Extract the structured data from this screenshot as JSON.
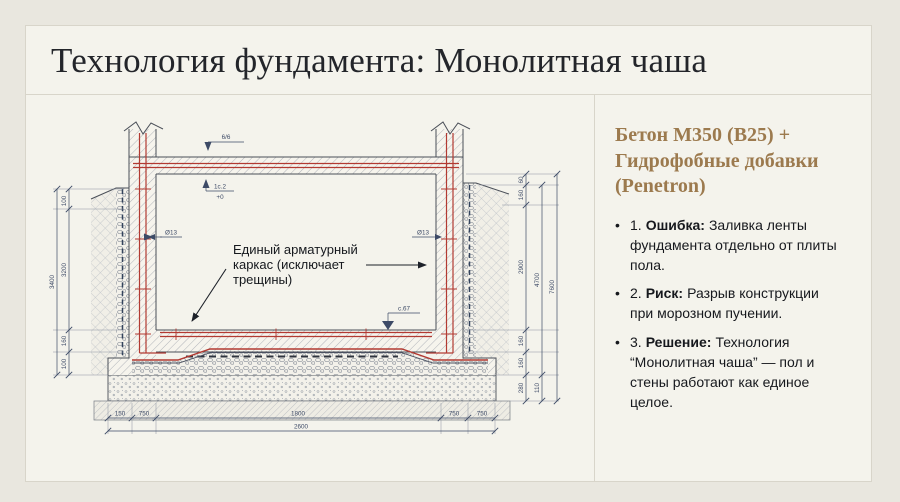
{
  "title": "Технология фундамента: Монолитная чаша",
  "colors": {
    "accent_heading": "#9c7a4e",
    "rebar_red": "#b23a32",
    "background": "#e9e7df"
  },
  "panel": {
    "heading": "Бетон М350 (В25) + Гидрофобные добавки (Penetron)",
    "bullets": [
      {
        "num": "1.",
        "term": "Ошибка:",
        "text": "Заливка ленты фундамента отдельно от плиты пола."
      },
      {
        "num": "2.",
        "term": "Риск:",
        "text": "Разрыв конструкции при морозном пучении."
      },
      {
        "num": "3.",
        "term": "Решение:",
        "text": "Технология “Монолитная чаша” — пол и стены работают как единое целое."
      }
    ]
  },
  "drawing": {
    "annotation": {
      "line1": "Единый арматурный",
      "line2": "каркас (исключает",
      "line3": "трещины)"
    },
    "marks": {
      "section": "6/6",
      "slope": "1с.2",
      "zero": "+0",
      "rebar_left": "Ø13",
      "rebar_right": "Ø13",
      "level": "с.67"
    },
    "dims": {
      "left": [
        "100",
        "3200",
        "160",
        "100"
      ],
      "left_overall": "3400",
      "right": [
        "60",
        "160",
        "2900",
        "160",
        "160",
        "280"
      ],
      "right_mid": [
        "4700",
        "110"
      ],
      "right_overall": "7600",
      "bottom": [
        "150",
        "750",
        "1800",
        "750",
        "750"
      ],
      "bottom_overall": "2600"
    }
  }
}
